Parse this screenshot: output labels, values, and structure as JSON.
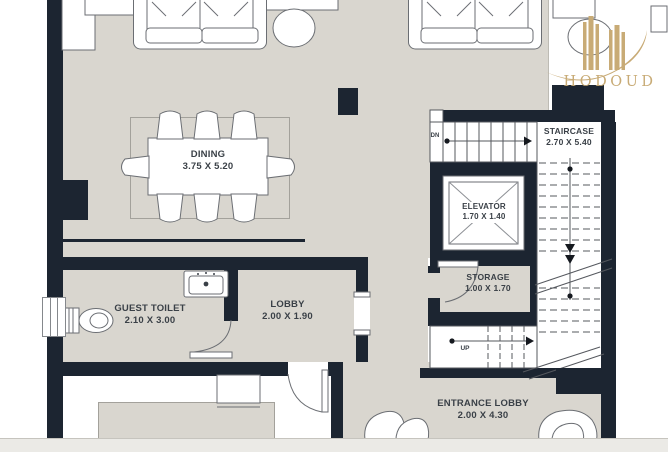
{
  "title": "Floor plan",
  "rooms": {
    "dining": {
      "name": "DINING",
      "dims": "3.75 X 5.20"
    },
    "guest_toilet": {
      "name": "GUEST TOILET",
      "dims": "2.10 X 3.00"
    },
    "lobby": {
      "name": "LOBBY",
      "dims": "2.00 X 1.90"
    },
    "staircase": {
      "name": "STAIRCASE",
      "dims": "2.70 X 5.40"
    },
    "elevator": {
      "name": "ELEVATOR",
      "dims": "1.70 X 1.40"
    },
    "storage": {
      "name": "STORAGE",
      "dims": "1.00 X 1.70"
    },
    "entrance_lobby": {
      "name": "ENTRANCE LOBBY",
      "dims": "2.00 X 4.30"
    }
  },
  "annotations": {
    "down": "DN",
    "up": "UP"
  },
  "logo": {
    "text": "HODOUD"
  },
  "colors": {
    "wall": "#1c2531",
    "floor": "#d9d6cf",
    "logo_gold": "#c8ab76",
    "label_text": "#3a4047"
  }
}
